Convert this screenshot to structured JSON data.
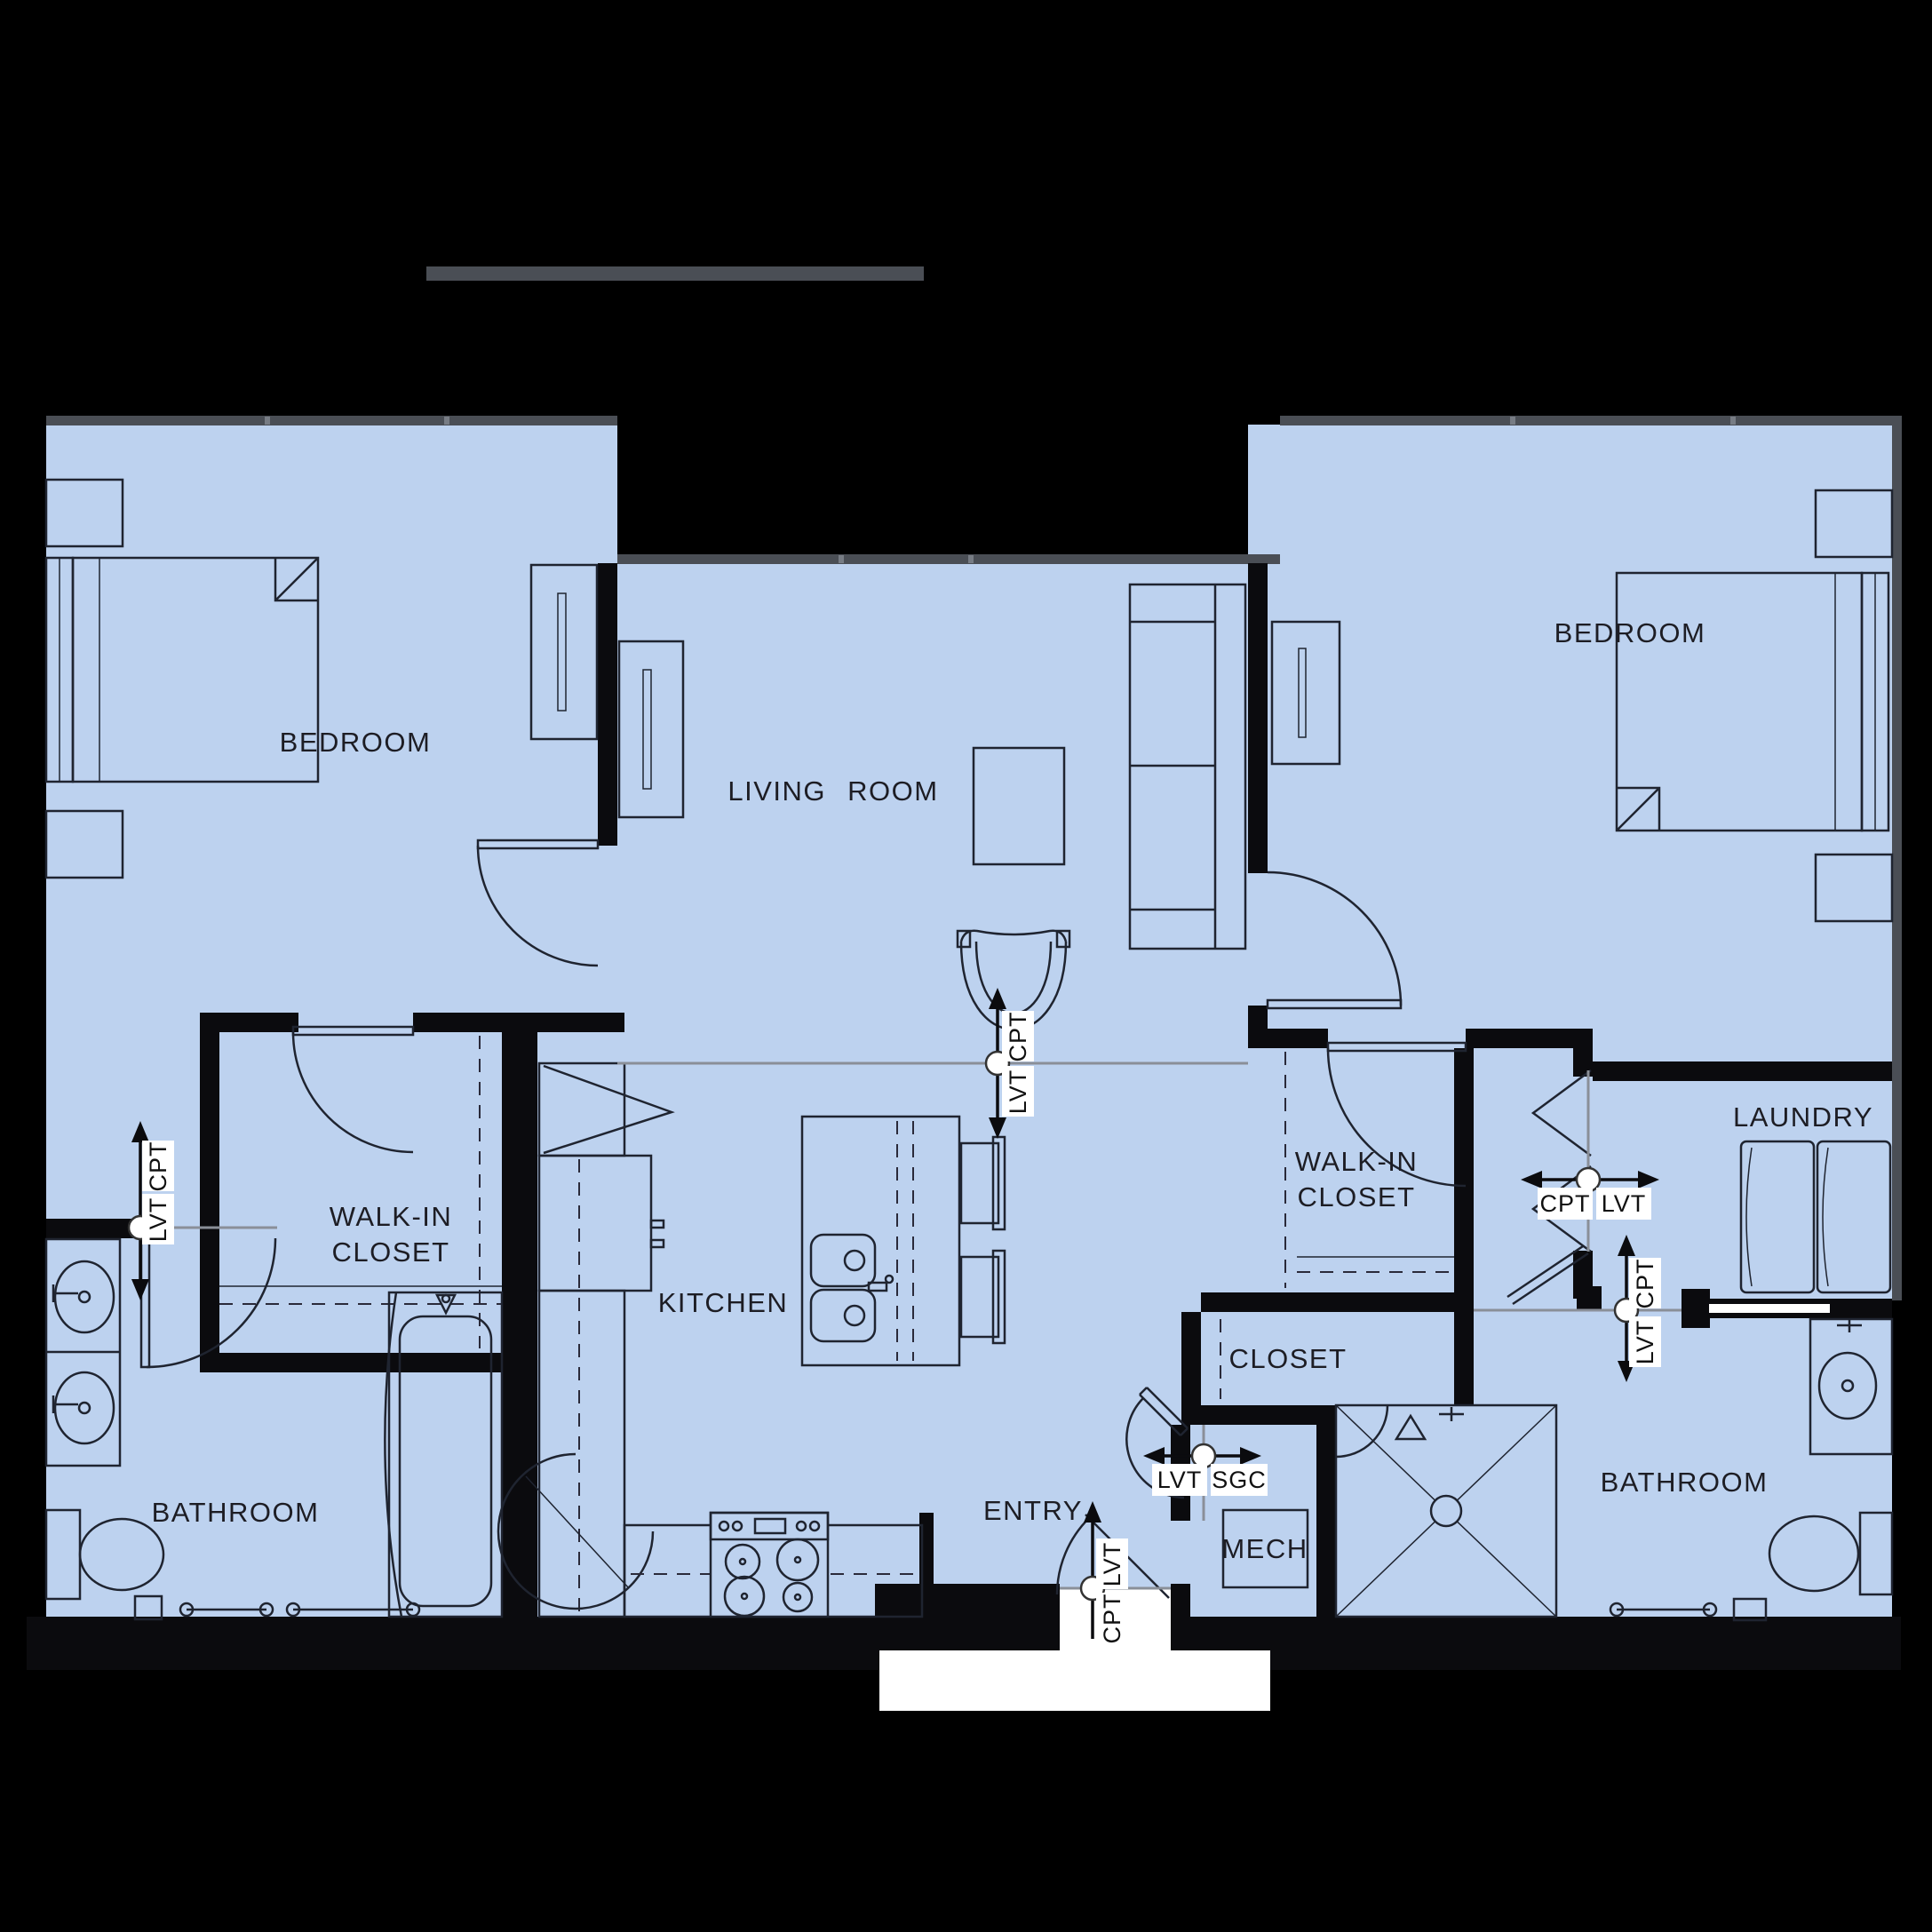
{
  "colors": {
    "background": "#000000",
    "floor": "#bdd2ef",
    "wall": "#0b0b0e",
    "window_band": "#4a4e55",
    "transition_line": "#8a8f98",
    "tag_background": "#ffffff",
    "label_text": "#1d1d24"
  },
  "rooms": {
    "bedroom_left": {
      "label": "BEDROOM"
    },
    "living_room": {
      "label": "LIVING ROOM"
    },
    "bedroom_right": {
      "label": "BEDROOM"
    },
    "walk_in_closet_left": {
      "line1": "WALK-IN",
      "line2": "CLOSET"
    },
    "walk_in_closet_right": {
      "line1": "WALK-IN",
      "line2": "CLOSET"
    },
    "kitchen": {
      "label": "KITCHEN"
    },
    "closet": {
      "label": "CLOSET"
    },
    "laundry": {
      "label": "LAUNDRY"
    },
    "bathroom_left": {
      "label": "BATHROOM"
    },
    "bathroom_right": {
      "label": "BATHROOM"
    },
    "entry": {
      "label": "ENTRY"
    },
    "mech": {
      "label": "MECH"
    }
  },
  "flooring_transitions": {
    "living_to_kitchen": {
      "orientation": "vertical",
      "top": "CPT",
      "bottom": "LVT"
    },
    "hall_to_bath_left": {
      "orientation": "vertical",
      "top": "CPT",
      "bottom": "LVT"
    },
    "hall_to_bath_right": {
      "orientation": "vertical",
      "top": "CPT",
      "bottom": "LVT"
    },
    "hall_to_laundry": {
      "orientation": "horizontal",
      "left": "CPT",
      "right": "LVT"
    },
    "entry_to_mech": {
      "orientation": "horizontal",
      "left": "LVT",
      "right": "SGC"
    },
    "entry_threshold": {
      "orientation": "vertical",
      "top": "LVT",
      "bottom": "CPT"
    }
  }
}
